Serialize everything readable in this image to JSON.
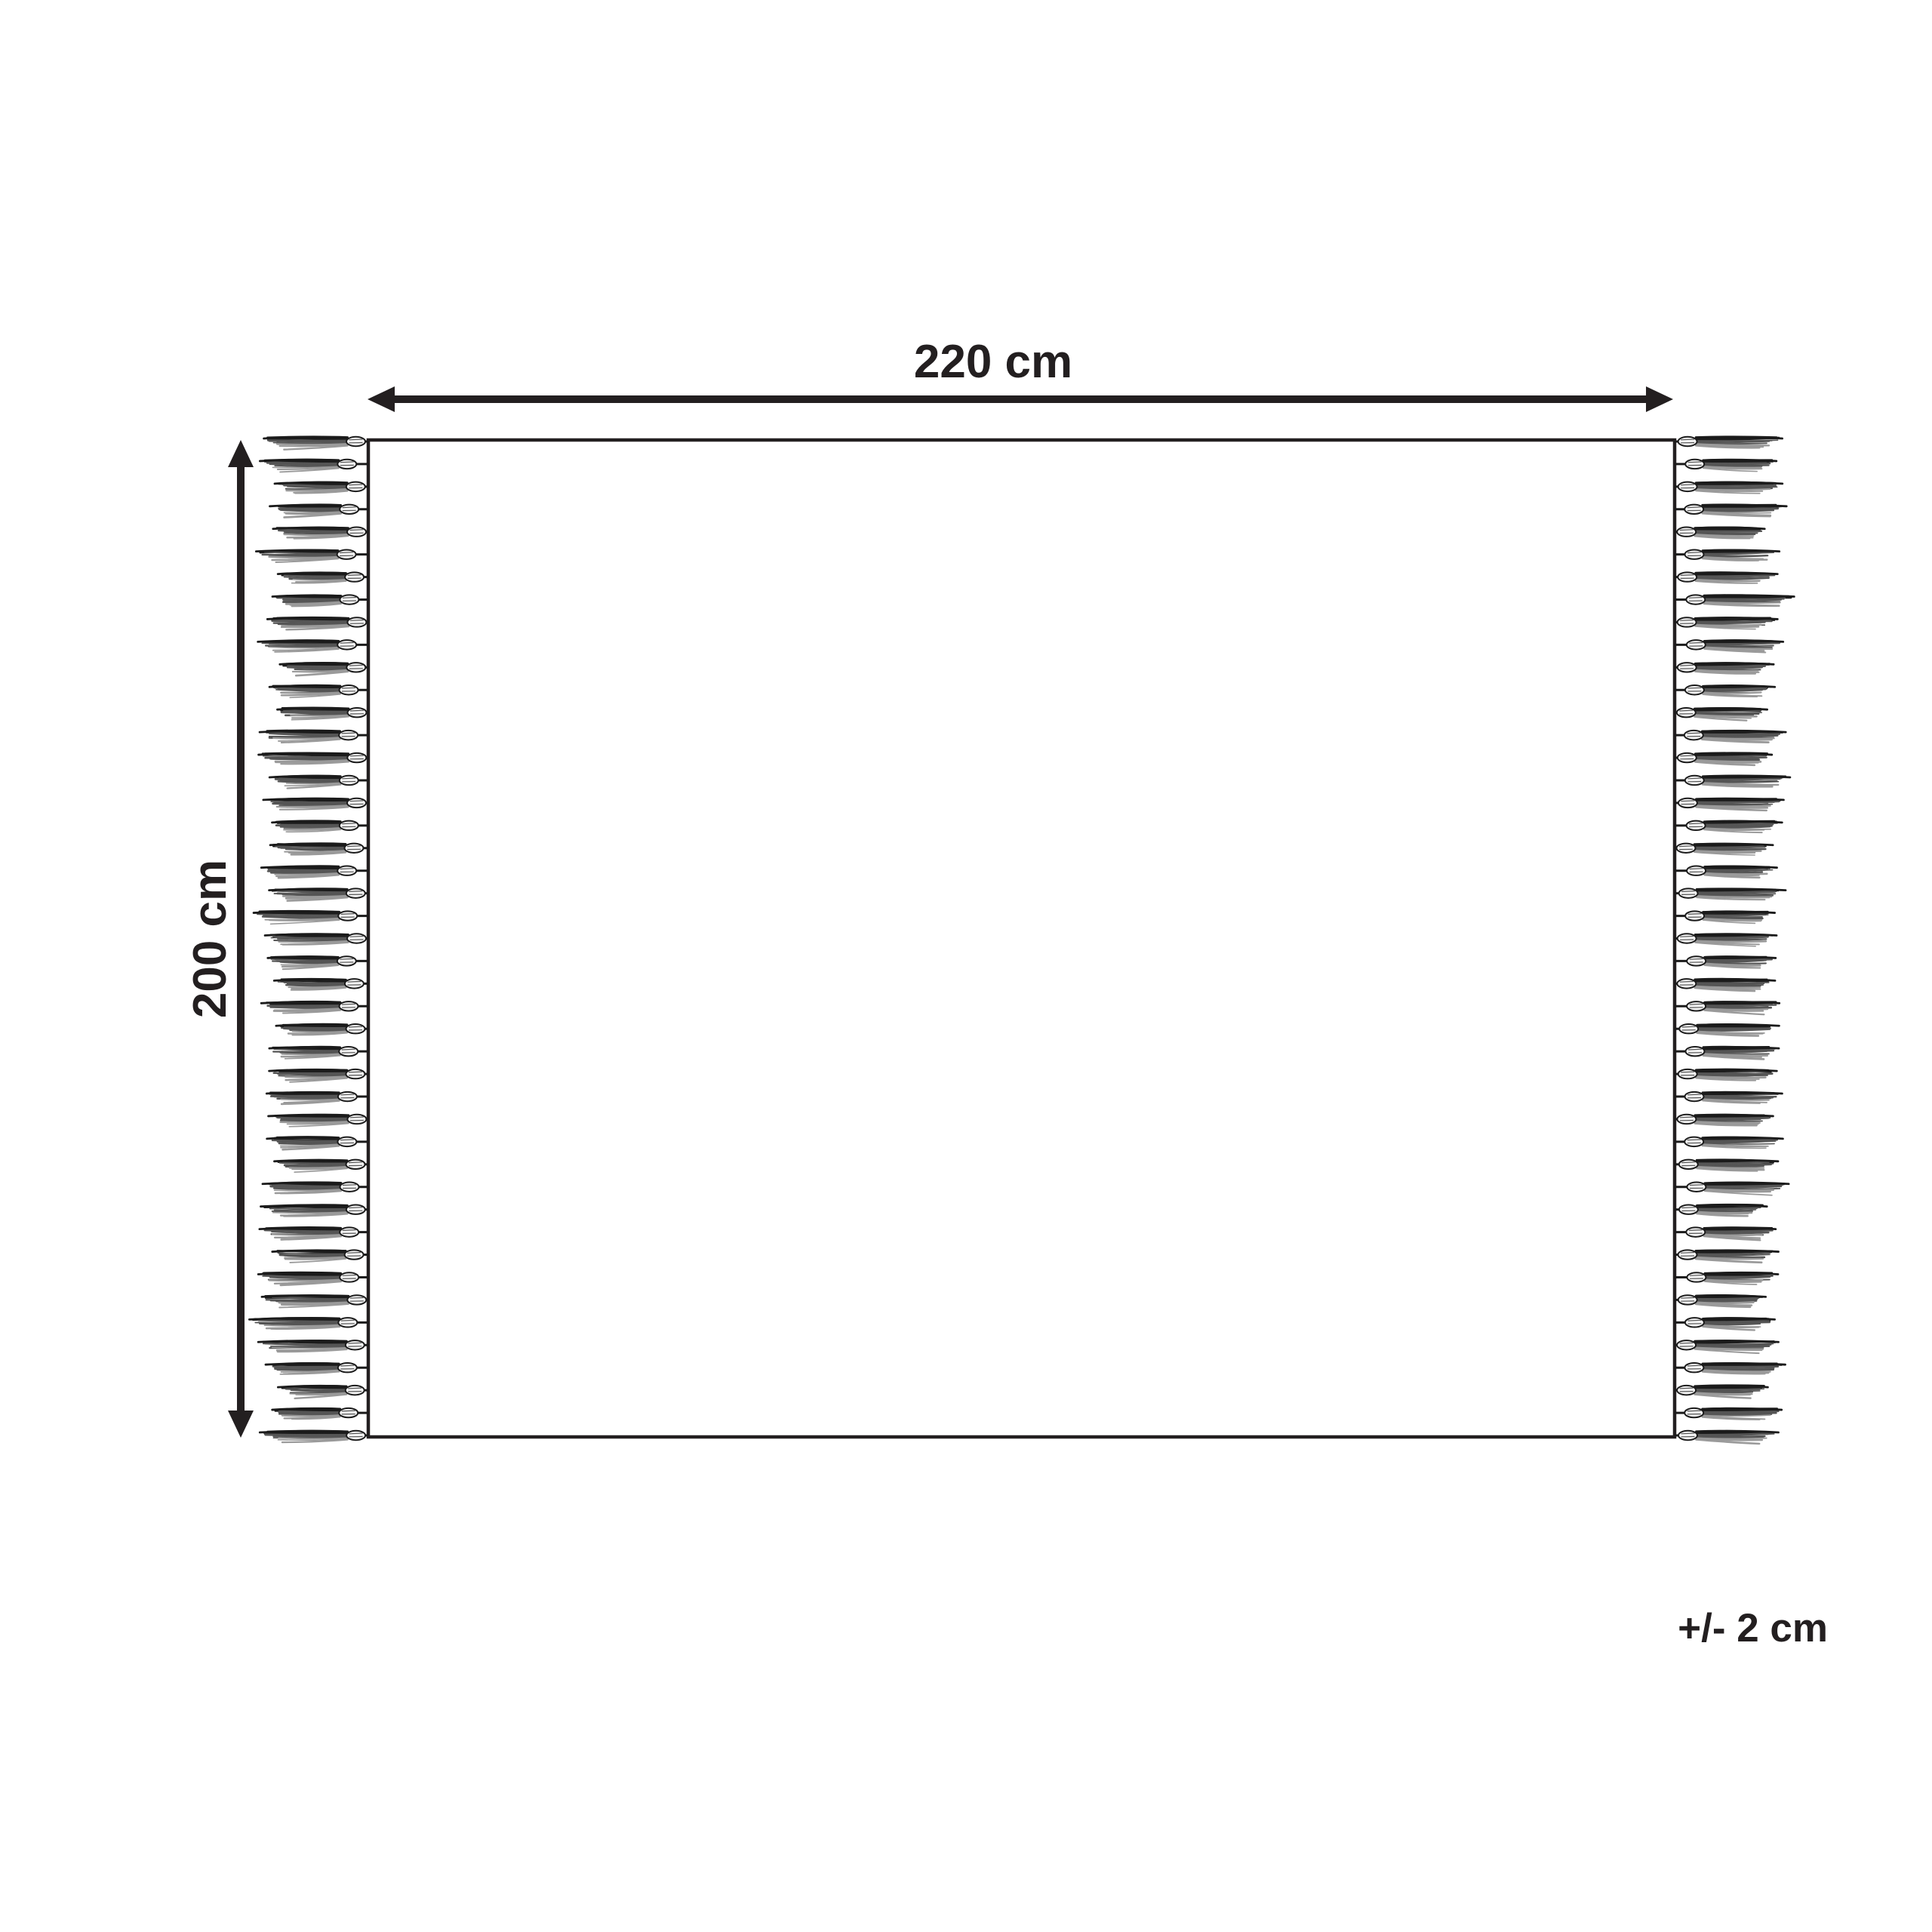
{
  "page": {
    "background_color": "#ffffff",
    "ink_color": "#231f20"
  },
  "diagram": {
    "width_label": "220 cm",
    "height_label": "200 cm",
    "tolerance_label": "+/- 2 cm",
    "fringe": {
      "sides": [
        "left",
        "right"
      ],
      "tassels_per_side": 45,
      "strand_colors": [
        "#1b1b1b",
        "#555555",
        "#9a9a9a"
      ],
      "knot_fill": "#f4f4f4"
    }
  }
}
